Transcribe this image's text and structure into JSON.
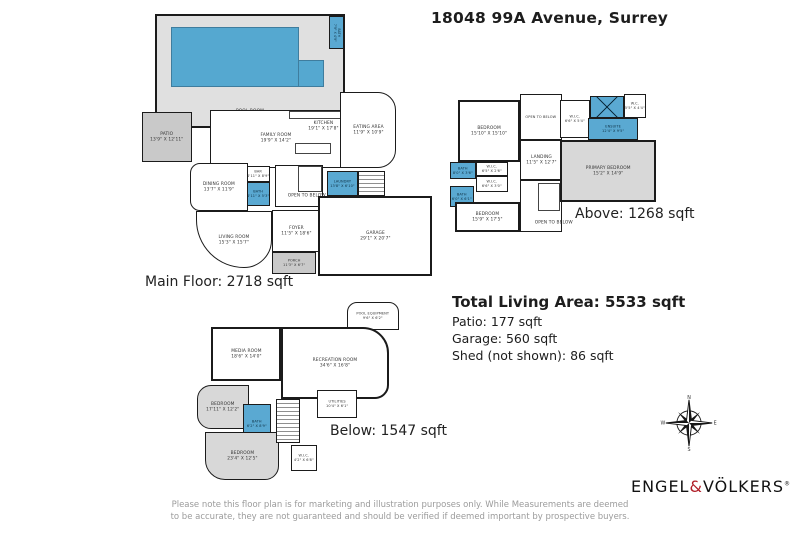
{
  "page": {
    "title": "18048 99A Avenue, Surrey"
  },
  "strings": {
    "open_to_below": "OPEN TO BELOW"
  },
  "floors": {
    "main": {
      "label": "Main Floor: 2718 sqft",
      "rooms": {
        "pool_room": {
          "name": "POOL ROOM",
          "dims": "46'11\" X 22'8\""
        },
        "pool_bath": {
          "name": "BATH",
          "dims": "7'9\" X 4'9\""
        },
        "patio": {
          "name": "PATIO",
          "dims": "13'9\" X 12'11\""
        },
        "family_room": {
          "name": "FAMILY ROOM",
          "dims": "19'9\" X 14'2\""
        },
        "kitchen": {
          "name": "KITCHEN",
          "dims": "19'1\" X 17'8\""
        },
        "eating_area": {
          "name": "EATING AREA",
          "dims": "11'9\" X 10'9\""
        },
        "bar": {
          "name": "BAR",
          "dims": "4'11\" X 8'9\""
        },
        "bath": {
          "name": "BATH",
          "dims": "4'11\" X 5'3\""
        },
        "dining_room": {
          "name": "DINING ROOM",
          "dims": "13'7\" X 11'9\""
        },
        "laundry": {
          "name": "LAUNDRY",
          "dims": "13'8\" X 6'10\""
        },
        "living_room": {
          "name": "LIVING ROOM",
          "dims": "15'3\" X 15'7\""
        },
        "foyer": {
          "name": "FOYER",
          "dims": "11'5\" X 18'6\""
        },
        "porch": {
          "name": "PORCH",
          "dims": "11'3\" X 6'7\""
        },
        "garage": {
          "name": "GARAGE",
          "dims": "29'1\" X 20'7\""
        }
      }
    },
    "above": {
      "label": "Above: 1268 sqft",
      "rooms": {
        "bedroom1": {
          "name": "BEDROOM",
          "dims": "15'10\" X 15'10\""
        },
        "landing": {
          "name": "LANDING",
          "dims": "11'5\" X 12'7\""
        },
        "wic_a": {
          "name": "W.I.C.",
          "dims": "6'5\" X 2'6\""
        },
        "wic_b": {
          "name": "W.I.C.",
          "dims": "6'6\" X 3'0\""
        },
        "bath_a": {
          "name": "BATH",
          "dims": "8'0\" X 3'6\""
        },
        "bath_b": {
          "name": "BATH",
          "dims": "6'0\" X 6'1\""
        },
        "bedroom2": {
          "name": "BEDROOM",
          "dims": "15'9\" X 17'5\""
        },
        "wic_c": {
          "name": "W.I.C.",
          "dims": "6'6\" X 5'4\""
        },
        "wc": {
          "name": "W.C.",
          "dims": "5'5\" X 4'4\""
        },
        "ensuite": {
          "name": "ENSUITE",
          "dims": "12'4\" X 9'5\""
        },
        "primary_bedroom": {
          "name": "PRIMARY BEDROOM",
          "dims": "15'2\" X 14'9\""
        }
      }
    },
    "below": {
      "label": "Below: 1547 sqft",
      "rooms": {
        "pool_equipment": {
          "name": "POOL EQUIPMENT",
          "dims": "9'6\" X 6'2\""
        },
        "media_room": {
          "name": "MEDIA ROOM",
          "dims": "18'6\" X 14'0\""
        },
        "recreation_room": {
          "name": "RECREATION ROOM",
          "dims": "34'6\" X 16'8\""
        },
        "bedroom3": {
          "name": "BEDROOM",
          "dims": "17'11\" X 12'2\""
        },
        "bath3": {
          "name": "BATH",
          "dims": "6'2\" X 8'9\""
        },
        "bedroom4": {
          "name": "BEDROOM",
          "dims": "23'4\" X 12'5\""
        },
        "wic4": {
          "name": "W.I.C.",
          "dims": "4'2\" X 6'8\""
        },
        "utilities": {
          "name": "UTILITIES",
          "dims": "10'4\" X 6'1\""
        }
      }
    }
  },
  "summary": {
    "total": "Total Living Area: 5533 sqft",
    "patio": "Patio: 177 sqft",
    "garage": "Garage: 560 sqft",
    "shed": "Shed (not shown): 86 sqft"
  },
  "compass": {
    "n": "N",
    "e": "E",
    "s": "S",
    "w": "W"
  },
  "brand": {
    "part1": "ENGEL",
    "amp": "&",
    "part2": "VÖLKERS",
    "reg": "®"
  },
  "disclaimer": "Please note this floor plan is for marketing and illustration purposes only. While Measurements are deemed to be accurate, they are not guaranteed and should be verified if deemed important by prospective buyers.",
  "colors": {
    "pool_blue": "#55a8d0",
    "wet_room_blue": "#5aa9d2",
    "patio_gray": "#c9c9c9",
    "carpet_gray": "#d8d8d8",
    "wall": "#1b1b1b",
    "brand_red": "#b01e28"
  }
}
